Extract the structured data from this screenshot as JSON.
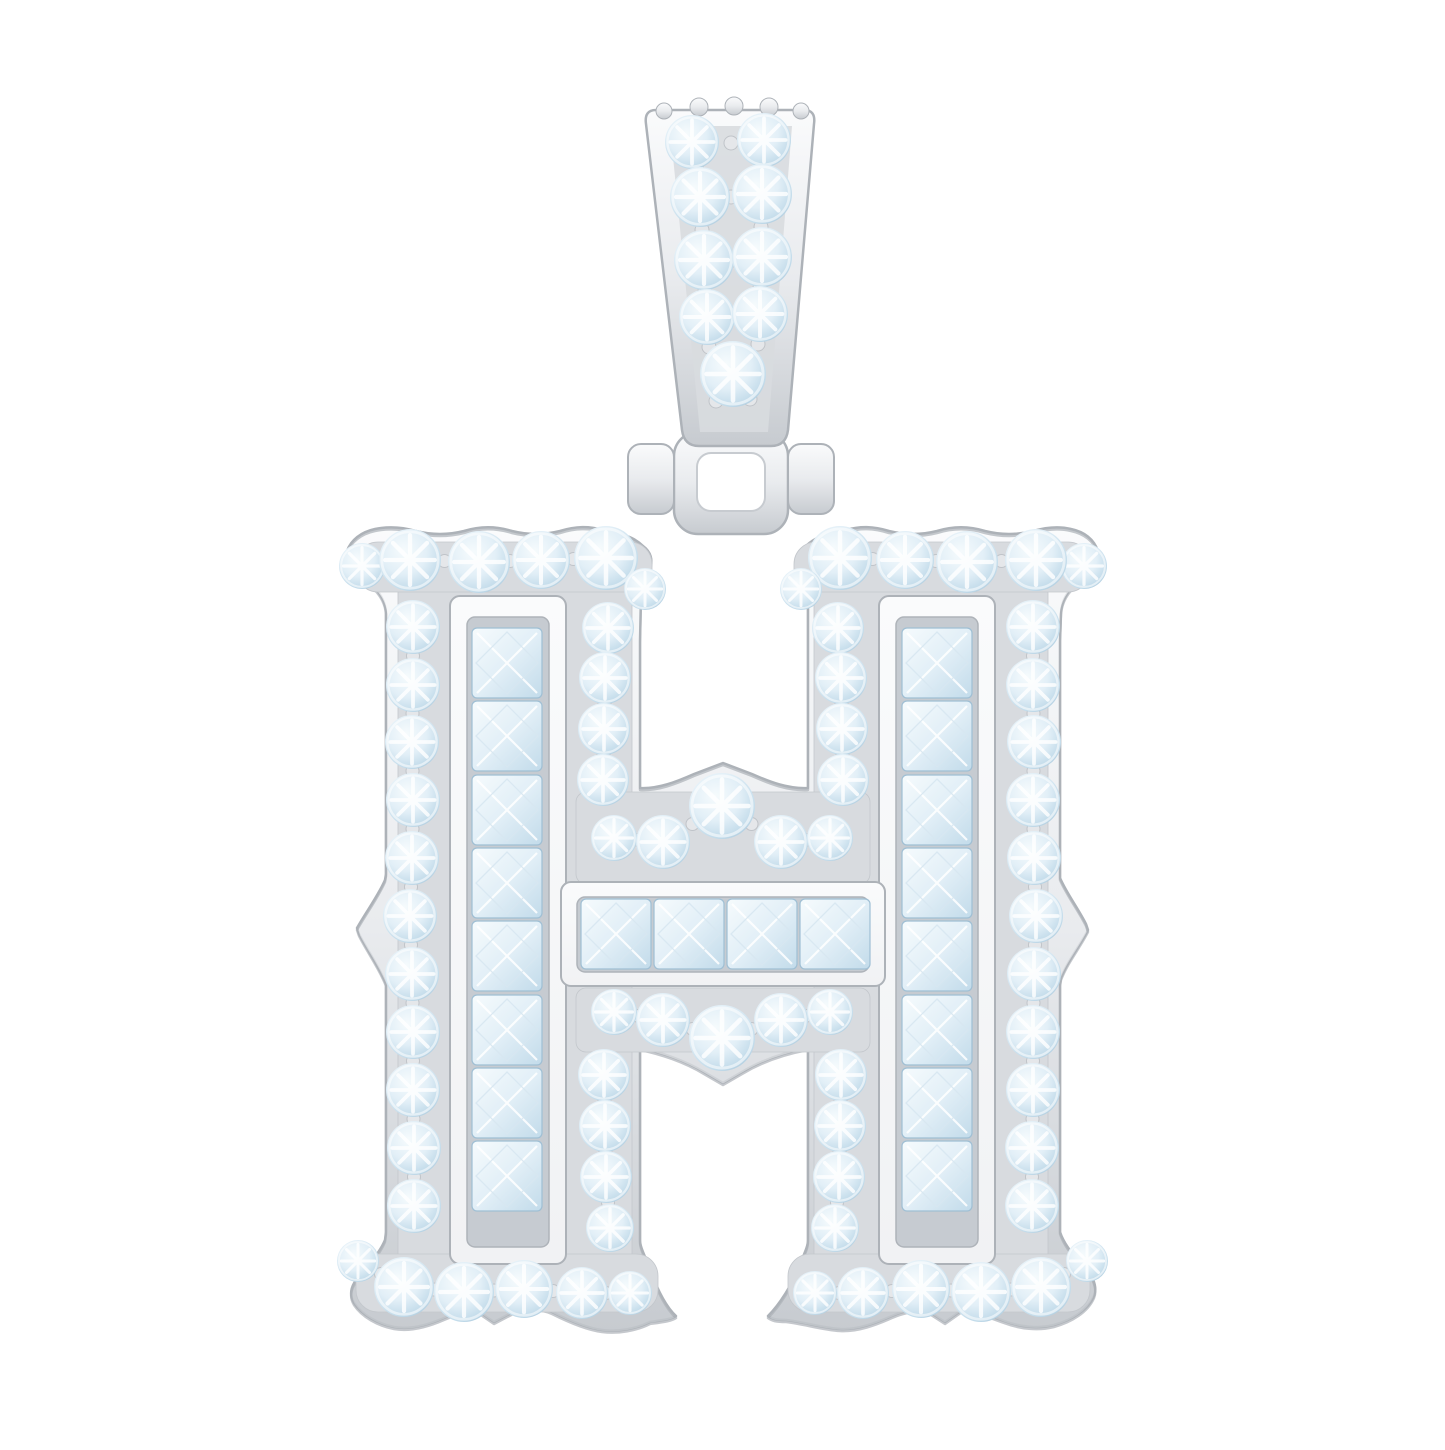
{
  "scene": {
    "description": "Product photograph of a polished white-metal gothic block letter H pendant, pave-set with round brilliant clear stones and channel-set princess-cut stones, hung from a tapered two-row diamond bail with a hinged connector, on a plain white background.",
    "background": "#ffffff"
  },
  "colors": {
    "metal_hi": "#fafbfc",
    "metal_mid": "#e9ebee",
    "metal_lo": "#c7cbd0",
    "metal_edge": "#adb2b8",
    "panel": "#d8dbdf",
    "panel_edge": "#c3c7cc",
    "frame": "#f1f2f4",
    "channel": "#c6cbd1",
    "channel_edge": "#aeb3b9",
    "stone_hi": "#f6fbfd",
    "stone_mid": "#e2eff7",
    "stone_lo": "#c2dbea",
    "stone_edge": "#9fbfd4",
    "diamond_line": "#d7e7f1",
    "prong": "#e5e7ea",
    "prong_edge": "#c0c4c9",
    "white": "#ffffff"
  },
  "bail": {
    "stones": [
      [
        692,
        142,
        27
      ],
      [
        764,
        140,
        27
      ],
      [
        700,
        197,
        30
      ],
      [
        762,
        194,
        30
      ],
      [
        704,
        260,
        30
      ],
      [
        762,
        257,
        30
      ],
      [
        707,
        317,
        28
      ],
      [
        760,
        314,
        28
      ],
      [
        733,
        374,
        33
      ]
    ],
    "bumps": [
      [
        664,
        111,
        8
      ],
      [
        699,
        107,
        9
      ],
      [
        734,
        106,
        9
      ],
      [
        769,
        107,
        9
      ],
      [
        801,
        111,
        8
      ]
    ],
    "prongs": [
      [
        731,
        143
      ],
      [
        731,
        197
      ],
      [
        733,
        260
      ],
      [
        733,
        317
      ],
      [
        697,
        170
      ],
      [
        762,
        167
      ],
      [
        702,
        230
      ],
      [
        761,
        227
      ],
      [
        705,
        291
      ],
      [
        760,
        288
      ],
      [
        709,
        347
      ],
      [
        758,
        344
      ],
      [
        716,
        401
      ],
      [
        750,
        399
      ]
    ]
  },
  "hinge": {
    "ring_outer": [
      674,
      432,
      114,
      102,
      24
    ],
    "ring_inner": [
      697,
      453,
      68,
      58,
      14
    ],
    "side_prongs": [
      [
        628,
        444,
        46,
        70,
        13
      ],
      [
        788,
        444,
        46,
        70,
        13
      ]
    ]
  },
  "h": {
    "pave_panels": [
      [
        398,
        556,
        234,
        748,
        16
      ],
      [
        814,
        556,
        234,
        748,
        16
      ],
      [
        356,
        542,
        296,
        50,
        22
      ],
      [
        794,
        542,
        296,
        50,
        22
      ],
      [
        356,
        1254,
        302,
        58,
        22
      ],
      [
        788,
        1254,
        302,
        58,
        22
      ],
      [
        576,
        792,
        294,
        92,
        10
      ],
      [
        576,
        988,
        294,
        64,
        10
      ]
    ],
    "channels": [
      {
        "frame": [
          450,
          596,
          116,
          668,
          10
        ],
        "inner": [
          467,
          617,
          82,
          630,
          8
        ]
      },
      {
        "frame": [
          879,
          596,
          116,
          668,
          10
        ],
        "inner": [
          896,
          617,
          82,
          630,
          8
        ]
      },
      {
        "frame": [
          561,
          882,
          324,
          104,
          10
        ],
        "inner": [
          577,
          897,
          292,
          75,
          8
        ]
      }
    ],
    "princess_sets": [
      {
        "type": "v",
        "x": 472,
        "size": 70,
        "ys": [
          628,
          701,
          775,
          848,
          921,
          995,
          1068,
          1141
        ]
      },
      {
        "type": "v",
        "x": 902,
        "size": 70,
        "ys": [
          628,
          701,
          775,
          848,
          921,
          995,
          1068,
          1141
        ]
      },
      {
        "type": "h",
        "y": 899,
        "size": 70,
        "xs": [
          581,
          654,
          727,
          800
        ]
      }
    ],
    "round_groups": [
      {
        "name": "serif-top-left",
        "stones": [
          [
            362,
            566,
            23
          ],
          [
            410,
            560,
            31
          ],
          [
            479,
            562,
            31
          ],
          [
            541,
            560,
            29
          ],
          [
            606,
            558,
            32
          ],
          [
            645,
            589,
            21
          ]
        ]
      },
      {
        "name": "serif-top-right",
        "stones": [
          [
            1084,
            566,
            23
          ],
          [
            1036,
            560,
            31
          ],
          [
            967,
            562,
            31
          ],
          [
            905,
            560,
            29
          ],
          [
            840,
            558,
            32
          ],
          [
            801,
            589,
            21
          ]
        ]
      },
      {
        "name": "outer-column-left",
        "stones": [
          [
            413,
            627,
            27
          ],
          [
            413,
            685,
            27
          ],
          [
            412,
            742,
            27
          ],
          [
            413,
            800,
            27
          ],
          [
            412,
            858,
            27
          ],
          [
            410,
            916,
            27
          ],
          [
            412,
            974,
            27
          ],
          [
            413,
            1032,
            27
          ],
          [
            413,
            1090,
            27
          ],
          [
            414,
            1148,
            27
          ],
          [
            414,
            1206,
            27
          ]
        ]
      },
      {
        "name": "outer-column-right",
        "stones": [
          [
            1033,
            627,
            27
          ],
          [
            1033,
            685,
            27
          ],
          [
            1034,
            742,
            27
          ],
          [
            1033,
            800,
            27
          ],
          [
            1034,
            858,
            27
          ],
          [
            1036,
            916,
            27
          ],
          [
            1034,
            974,
            27
          ],
          [
            1033,
            1032,
            27
          ],
          [
            1033,
            1090,
            27
          ],
          [
            1032,
            1148,
            27
          ],
          [
            1032,
            1206,
            27
          ]
        ]
      },
      {
        "name": "inner-column-left-upper",
        "stones": [
          [
            608,
            628,
            26
          ],
          [
            605,
            678,
            26
          ],
          [
            604,
            729,
            26
          ],
          [
            603,
            780,
            26
          ]
        ]
      },
      {
        "name": "inner-column-right-upper",
        "stones": [
          [
            838,
            628,
            26
          ],
          [
            841,
            678,
            26
          ],
          [
            842,
            729,
            26
          ],
          [
            843,
            780,
            26
          ]
        ]
      },
      {
        "name": "crossbar-row-upper",
        "stones": [
          [
            614,
            838,
            23
          ],
          [
            663,
            842,
            27
          ],
          [
            722,
            806,
            33
          ],
          [
            781,
            842,
            27
          ],
          [
            830,
            838,
            23
          ]
        ]
      },
      {
        "name": "crossbar-row-lower",
        "stones": [
          [
            614,
            1012,
            23
          ],
          [
            663,
            1020,
            27
          ],
          [
            722,
            1038,
            33
          ],
          [
            781,
            1020,
            27
          ],
          [
            830,
            1012,
            23
          ]
        ]
      },
      {
        "name": "inner-column-left-lower",
        "stones": [
          [
            604,
            1075,
            26
          ],
          [
            605,
            1126,
            26
          ],
          [
            606,
            1177,
            26
          ],
          [
            610,
            1228,
            24
          ]
        ]
      },
      {
        "name": "inner-column-right-lower",
        "stones": [
          [
            841,
            1075,
            26
          ],
          [
            840,
            1126,
            26
          ],
          [
            839,
            1177,
            26
          ],
          [
            835,
            1228,
            24
          ]
        ]
      },
      {
        "name": "foot-left",
        "stones": [
          [
            358,
            1261,
            21
          ],
          [
            404,
            1287,
            30
          ],
          [
            464,
            1292,
            30
          ],
          [
            524,
            1289,
            29
          ],
          [
            582,
            1293,
            26
          ],
          [
            630,
            1293,
            22
          ]
        ]
      },
      {
        "name": "foot-right",
        "stones": [
          [
            1087,
            1261,
            21
          ],
          [
            1041,
            1287,
            30
          ],
          [
            981,
            1292,
            30
          ],
          [
            921,
            1289,
            29
          ],
          [
            863,
            1293,
            26
          ],
          [
            815,
            1293,
            22
          ]
        ]
      }
    ]
  }
}
